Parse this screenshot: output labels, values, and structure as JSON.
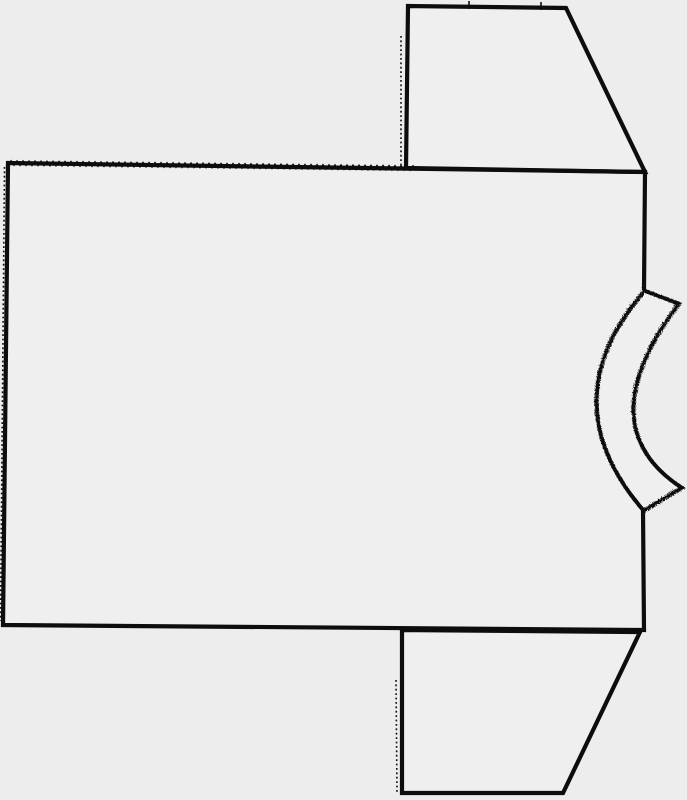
{
  "canvas": {
    "width": 687,
    "height": 800,
    "background": "#ededed",
    "ink": "#0d0d0d",
    "panel_fill": "#efefef"
  },
  "shapes": {
    "body_fill": "M8,163 L645,172 L644,290 Q548,400 643,510 L644,630 L3,625 Z",
    "body_outline": "M644,290 L645,172 L8,163 L3,625 L644,630 L643,510",
    "top_sleeve": "M406,168 L408,6 L566,8 L645,172 Z",
    "bottom_sleeve": "M402,630 L640,632 L563,793 L402,793 Z",
    "neckband": "M644,290 L678,303 Q586,425 681,487 L643,510 Q548,400 644,290 Z",
    "top_pinked_edge": "M8,165l3,-4l3,4l3,-4l3,4l3,-4l3,4l3,-4l3,4l3,-4l3,4l3,-4l3,4l3,-4l3,4l3,-4l3,4l3,-4l3,4l3,-4l3,4l3,-4l3,4l3,-4l3,4l3,-4l3,4l3,-4l3,4l3,-4l3,4l3,-4l3,4l3,-4l3,4l3,-4l3,4l3,-4l3,4l3,-4l3,4l3,-4l3,4l3,-4l3,4l3,-4l3,4l3,-4l3,4l3,-4l3,4l3,-4l3,4l3,-4l3,4l3,-4l3,4l3,-4l3,4l3,-4l3,4l3,-4l3,4l3,-4l3,4l3,-4l3,4l3,-4l3,4l3,-4l3,4l3,-4l3,4l3,-4l3,4l3,-4l3,4l3,-4l3,4l3,-4l3,4l3,-4l3,4l3,-4l3,4l3,-4l3,4l3,-4l3,4l3,-4l3,4l3,-4l3,4l3,-4l3,4l3,-4l3,4l3,-4l3,4l3,-4l3,4l3,-4l3,4l3,-4l3,4l3,-4l3,4l3,-4l3,4l3,-4l3,4l3,-4l3,4l3,-4l3,4l3,-4l3,4l3,-4l3,4l3,-4l3,4l3,-4l3,4l3,-4l3,4l3,-4l3,4l3,-4l3,4l3,-4l3,4l3,-4l3,4l3,-4l3,4l3,-4l3,4",
    "left_pinked_edge": "M4.5,167 L0.5,621",
    "top_sleeve_inner_dotted": "M401,36 L401,166",
    "bottom_sleeve_inner_dotted": "M396,680 L397,792",
    "notch_a": "M469,1 L469,9",
    "notch_b": "M541,2 L541,10"
  }
}
